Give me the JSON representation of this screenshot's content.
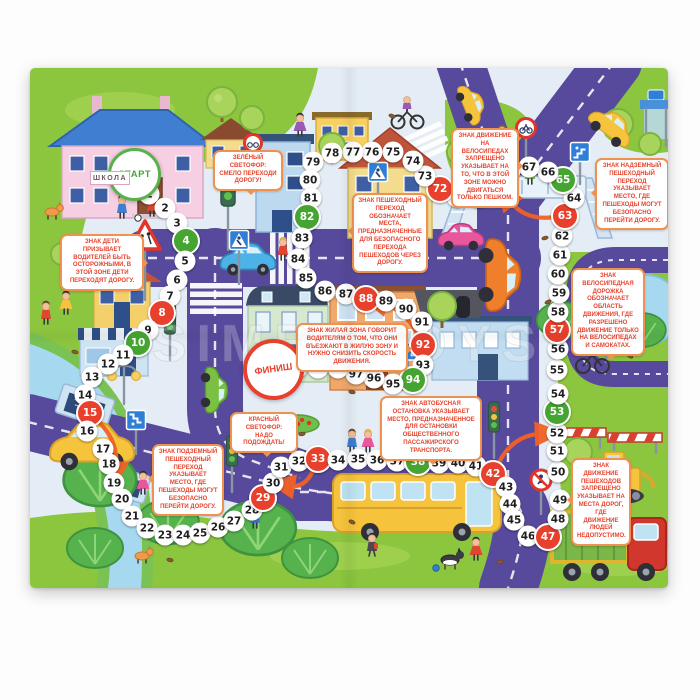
{
  "board": {
    "start_label": "СТАРТ",
    "finish_label": "ФИНИШ",
    "school_sign": "ШКОЛА",
    "watermark": "SIMBATOYS",
    "colors": {
      "grass": "#8cc53e",
      "road": "#57499b",
      "sidewalk": "#e4edf5",
      "red_space": "#e8402c",
      "green_space": "#46a532",
      "callout_text": "#e8432d",
      "callout_border": "#f0914f",
      "arrow": "#f26125"
    },
    "spaces": [
      {
        "n": 1,
        "x": 149,
        "y": 194
      },
      {
        "n": 2,
        "x": 165,
        "y": 208
      },
      {
        "n": 3,
        "x": 177,
        "y": 223
      },
      {
        "n": 4,
        "x": 186,
        "y": 241,
        "type": "green"
      },
      {
        "n": 5,
        "x": 185,
        "y": 261
      },
      {
        "n": 6,
        "x": 177,
        "y": 280
      },
      {
        "n": 7,
        "x": 170,
        "y": 296
      },
      {
        "n": 8,
        "x": 162,
        "y": 313,
        "type": "red"
      },
      {
        "n": 9,
        "x": 148,
        "y": 330
      },
      {
        "n": 10,
        "x": 138,
        "y": 343,
        "type": "green"
      },
      {
        "n": 11,
        "x": 123,
        "y": 355
      },
      {
        "n": 12,
        "x": 108,
        "y": 364
      },
      {
        "n": 13,
        "x": 92,
        "y": 377
      },
      {
        "n": 14,
        "x": 85,
        "y": 395
      },
      {
        "n": 15,
        "x": 90,
        "y": 413,
        "type": "red"
      },
      {
        "n": 16,
        "x": 87,
        "y": 431
      },
      {
        "n": 17,
        "x": 103,
        "y": 449
      },
      {
        "n": 18,
        "x": 109,
        "y": 464
      },
      {
        "n": 19,
        "x": 114,
        "y": 483
      },
      {
        "n": 20,
        "x": 122,
        "y": 499
      },
      {
        "n": 21,
        "x": 132,
        "y": 516
      },
      {
        "n": 22,
        "x": 147,
        "y": 528
      },
      {
        "n": 23,
        "x": 165,
        "y": 535
      },
      {
        "n": 24,
        "x": 183,
        "y": 535
      },
      {
        "n": 25,
        "x": 200,
        "y": 533
      },
      {
        "n": 26,
        "x": 218,
        "y": 527
      },
      {
        "n": 27,
        "x": 234,
        "y": 521
      },
      {
        "n": 28,
        "x": 252,
        "y": 510
      },
      {
        "n": 29,
        "x": 263,
        "y": 498,
        "type": "red"
      },
      {
        "n": 30,
        "x": 273,
        "y": 483
      },
      {
        "n": 31,
        "x": 281,
        "y": 467
      },
      {
        "n": 32,
        "x": 299,
        "y": 461
      },
      {
        "n": 33,
        "x": 318,
        "y": 459,
        "type": "red"
      },
      {
        "n": 34,
        "x": 338,
        "y": 460
      },
      {
        "n": 35,
        "x": 358,
        "y": 459
      },
      {
        "n": 36,
        "x": 377,
        "y": 460
      },
      {
        "n": 37,
        "x": 397,
        "y": 461
      },
      {
        "n": 38,
        "x": 418,
        "y": 462,
        "type": "green"
      },
      {
        "n": 39,
        "x": 439,
        "y": 463
      },
      {
        "n": 40,
        "x": 458,
        "y": 463
      },
      {
        "n": 41,
        "x": 476,
        "y": 466
      },
      {
        "n": 42,
        "x": 493,
        "y": 474,
        "type": "red"
      },
      {
        "n": 43,
        "x": 506,
        "y": 487
      },
      {
        "n": 44,
        "x": 510,
        "y": 504
      },
      {
        "n": 45,
        "x": 514,
        "y": 520
      },
      {
        "n": 46,
        "x": 528,
        "y": 536
      },
      {
        "n": 47,
        "x": 548,
        "y": 537,
        "type": "red"
      },
      {
        "n": 48,
        "x": 558,
        "y": 519
      },
      {
        "n": 49,
        "x": 560,
        "y": 500
      },
      {
        "n": 50,
        "x": 558,
        "y": 472
      },
      {
        "n": 51,
        "x": 557,
        "y": 451
      },
      {
        "n": 52,
        "x": 557,
        "y": 433
      },
      {
        "n": 53,
        "x": 557,
        "y": 412,
        "type": "green"
      },
      {
        "n": 54,
        "x": 558,
        "y": 394
      },
      {
        "n": 55,
        "x": 557,
        "y": 370
      },
      {
        "n": 56,
        "x": 558,
        "y": 349
      },
      {
        "n": 57,
        "x": 557,
        "y": 330,
        "type": "red"
      },
      {
        "n": 58,
        "x": 558,
        "y": 312
      },
      {
        "n": 59,
        "x": 559,
        "y": 293
      },
      {
        "n": 60,
        "x": 558,
        "y": 274
      },
      {
        "n": 61,
        "x": 560,
        "y": 255
      },
      {
        "n": 62,
        "x": 562,
        "y": 236
      },
      {
        "n": 63,
        "x": 565,
        "y": 216,
        "type": "red"
      },
      {
        "n": 64,
        "x": 574,
        "y": 198
      },
      {
        "n": 65,
        "x": 563,
        "y": 180,
        "type": "green"
      },
      {
        "n": 66,
        "x": 548,
        "y": 172
      },
      {
        "n": 67,
        "x": 529,
        "y": 167
      },
      {
        "n": 68,
        "x": 510,
        "y": 171
      },
      {
        "n": 69,
        "x": 500,
        "y": 188
      },
      {
        "n": 70,
        "x": 478,
        "y": 197
      },
      {
        "n": 71,
        "x": 457,
        "y": 197
      },
      {
        "n": 72,
        "x": 440,
        "y": 189,
        "type": "red"
      },
      {
        "n": 73,
        "x": 425,
        "y": 176
      },
      {
        "n": 74,
        "x": 413,
        "y": 161
      },
      {
        "n": 75,
        "x": 393,
        "y": 152
      },
      {
        "n": 76,
        "x": 372,
        "y": 152
      },
      {
        "n": 77,
        "x": 353,
        "y": 152
      },
      {
        "n": 78,
        "x": 332,
        "y": 153
      },
      {
        "n": 79,
        "x": 313,
        "y": 162
      },
      {
        "n": 80,
        "x": 310,
        "y": 180
      },
      {
        "n": 81,
        "x": 311,
        "y": 198
      },
      {
        "n": 82,
        "x": 307,
        "y": 217,
        "type": "green"
      },
      {
        "n": 83,
        "x": 302,
        "y": 238
      },
      {
        "n": 84,
        "x": 298,
        "y": 259
      },
      {
        "n": 85,
        "x": 306,
        "y": 278
      },
      {
        "n": 86,
        "x": 325,
        "y": 291
      },
      {
        "n": 87,
        "x": 346,
        "y": 294
      },
      {
        "n": 88,
        "x": 366,
        "y": 299,
        "type": "red"
      },
      {
        "n": 89,
        "x": 386,
        "y": 301
      },
      {
        "n": 90,
        "x": 406,
        "y": 309
      },
      {
        "n": 91,
        "x": 422,
        "y": 322
      },
      {
        "n": 92,
        "x": 423,
        "y": 345,
        "type": "red"
      },
      {
        "n": 93,
        "x": 423,
        "y": 365
      },
      {
        "n": 94,
        "x": 413,
        "y": 380,
        "type": "green"
      },
      {
        "n": 95,
        "x": 393,
        "y": 384
      },
      {
        "n": 96,
        "x": 374,
        "y": 378
      },
      {
        "n": 97,
        "x": 356,
        "y": 374
      },
      {
        "n": 98,
        "x": 338,
        "y": 368
      },
      {
        "n": 99,
        "x": 318,
        "y": 368
      },
      {
        "n": 100,
        "x": 297,
        "y": 368
      }
    ],
    "arrows": [
      {
        "from": 15,
        "to": 19,
        "bend": -18
      },
      {
        "from": 33,
        "to": 30,
        "bend": -20
      },
      {
        "from": 42,
        "to": 52,
        "bend": -22
      },
      {
        "from": 63,
        "to": 69,
        "bend": -20
      },
      {
        "from": 92,
        "to": 88,
        "bend": 16
      }
    ],
    "callouts": [
      {
        "id": "children-sign",
        "x": 60,
        "y": 234,
        "w": 72,
        "tail": "right",
        "text": "ЗНАК ДЕТИ ПРИЗЫВАЕТ ВОДИТЕЛЕЙ БЫТЬ ОСТОРОЖНЫМИ, В ЭТОЙ ЗОНЕ ДЕТИ ПЕРЕХОДЯТ ДОРОГУ."
      },
      {
        "id": "green-light",
        "x": 213,
        "y": 150,
        "w": 58,
        "tail": "bottom",
        "text": "ЗЕЛЁНЫЙ СВЕТОФОР: СМЕЛО ПЕРЕХОДИ ДОРОГУ!"
      },
      {
        "id": "crosswalk-sign",
        "x": 352,
        "y": 193,
        "w": 64,
        "tail": "left",
        "text": "ЗНАК ПЕШЕХОДНЫЙ ПЕРЕХОД ОБОЗНАЧАЕТ МЕСТА, ПРЕДНАЗНАЧЕННЫЕ ДЛЯ БЕЗОПАСНОГО ПЕРЕХОДА ПЕШЕХОДОВ ЧЕРЕЗ ДОРОГУ."
      },
      {
        "id": "no-bicycles-sign",
        "x": 451,
        "y": 128,
        "w": 56,
        "tail": "right",
        "text": "ЗНАК ДВИЖЕНИЕ НА ВЕЛОСИПЕДАХ ЗАПРЕЩЕНО УКАЗЫВАЕТ НА ТО, ЧТО В ЭТОЙ ЗОНЕ МОЖНО ДВИГАТЬСЯ ТОЛЬКО ПЕШКОМ."
      },
      {
        "id": "overhead-crossing-sign",
        "x": 595,
        "y": 158,
        "w": 62,
        "tail": "left",
        "text": "ЗНАК НАДЗЕМНЫЙ ПЕШЕХОДНЫЙ ПЕРЕХОД УКАЗЫВАЕТ МЕСТО, ГДЕ ПЕШЕХОДЫ МОГУТ БЕЗОПАСНО ПЕРЕЙТИ ДОРОГУ."
      },
      {
        "id": "bike-path-sign",
        "x": 571,
        "y": 268,
        "w": 62,
        "tail": "bottom",
        "text": "ЗНАК ВЕЛОСИПЕДНАЯ ДОРОЖКА ОБОЗНАЧАЕТ ОБЛАСТЬ ДВИЖЕНИЯ, ГДЕ РАЗРЕШЕНО ДВИЖЕНИЕ ТОЛЬКО НА ВЕЛОСИПЕДАХ И САМОКАТАХ."
      },
      {
        "id": "residential-zone-sign",
        "x": 296,
        "y": 323,
        "w": 100,
        "tail": "right",
        "text": "ЗНАК ЖИЛАЯ ЗОНА ГОВОРИТ ВОДИТЕЛЯМ О ТОМ, ЧТО ОНИ ВЪЕЗЖАЮТ В ЖИЛУЮ ЗОНУ И НУЖНО СНИЗИТЬ СКОРОСТЬ ДВИЖЕНИЯ."
      },
      {
        "id": "red-light",
        "x": 230,
        "y": 412,
        "w": 56,
        "tail": "bottom",
        "text": "КРАСНЫЙ СВЕТОФОР: НАДО ПОДОЖДАТЬ!"
      },
      {
        "id": "underground-crossing-sign",
        "x": 152,
        "y": 444,
        "w": 60,
        "tail": "left",
        "text": "ЗНАК ПОДЗЕМНЫЙ ПЕШЕХОДНЫЙ ПЕРЕХОД УКАЗЫВАЕТ МЕСТО, ГДЕ ПЕШЕХОДЫ МОГУТ БЕЗОПАСНО ПЕРЕЙТИ ДОРОГУ."
      },
      {
        "id": "bus-stop-sign",
        "x": 380,
        "y": 396,
        "w": 90,
        "tail": "bottom",
        "text": "ЗНАК АВТОБУСНАЯ ОСТАНОВКА УКАЗЫВАЕТ МЕСТО, ПРЕДНАЗНАЧЕННОЕ ДЛЯ ОСТАНОВКИ ОБЩЕСТВЕННОГО ПАССАЖИРСКОГО ТРАНСПОРТА."
      },
      {
        "id": "no-pedestrians-sign",
        "x": 571,
        "y": 458,
        "w": 48,
        "tail": "left",
        "text": "ЗНАК ДВИЖЕНИЕ ПЕШЕХОДОВ ЗАПРЕЩЕНО УКАЗЫВАЕТ НА МЕСТА ДОРОГ, ГДЕ ДВИЖЕНИЕ ЛЮДЕЙ НЕДОПУСТИМО."
      }
    ]
  }
}
